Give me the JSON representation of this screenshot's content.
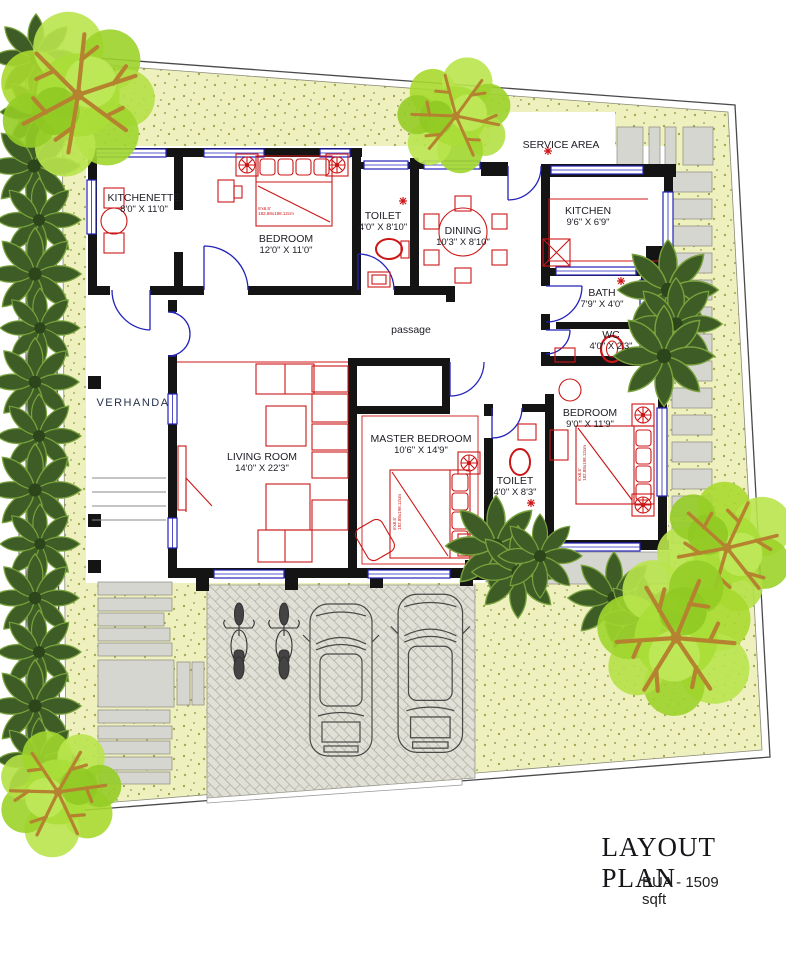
{
  "title_block": {
    "title": "LAYOUT PLAN",
    "bua": "BUA - 1509 sqft"
  },
  "rooms": {
    "kitchenette": {
      "name": "KITCHENETTE",
      "dims": "8'0\" X 11'0\""
    },
    "bedroom1": {
      "name": "BEDROOM",
      "dims": "12'0\" X 11'0\""
    },
    "toilet1": {
      "name": "TOILET",
      "dims": "4'0\" X 8'10\""
    },
    "dining": {
      "name": "DINING",
      "dims": "10'3\" X 8'10\""
    },
    "kitchen": {
      "name": "KITCHEN",
      "dims": "9'6\" X 6'9\""
    },
    "bath": {
      "name": "BATH",
      "dims": "7'9\" X 4'0\""
    },
    "wc": {
      "name": "WC",
      "dims": "4'0\" X 2'3\""
    },
    "bedroom2": {
      "name": "BEDROOM",
      "dims": "9'0\" X 11'9\""
    },
    "master": {
      "name": "MASTER BEDROOM",
      "dims": "10'6\" X 14'9\""
    },
    "toilet2": {
      "name": "TOILET",
      "dims": "4'0\" X 8'3\""
    },
    "living": {
      "name": "LIVING ROOM",
      "dims": "14'0\" X 22'3\""
    }
  },
  "areas": {
    "service_area": "SERVICE AREA",
    "passage": "passage",
    "verhanda": "VERHANDA"
  },
  "annotations": {
    "bed_size": "6'x6.5'",
    "bed_size_cm": "182.88x198.12cm"
  },
  "colors": {
    "ground_yellow": "#eef0bd",
    "wall_black": "#141414",
    "window_blue": "#2323bb",
    "furniture_red": "#cc1616",
    "tree_green": "#aadd38",
    "hedge_green": "#3e5d26",
    "paving_grey": "#e0e0d6",
    "slab_grey": "#d6d6d0"
  }
}
